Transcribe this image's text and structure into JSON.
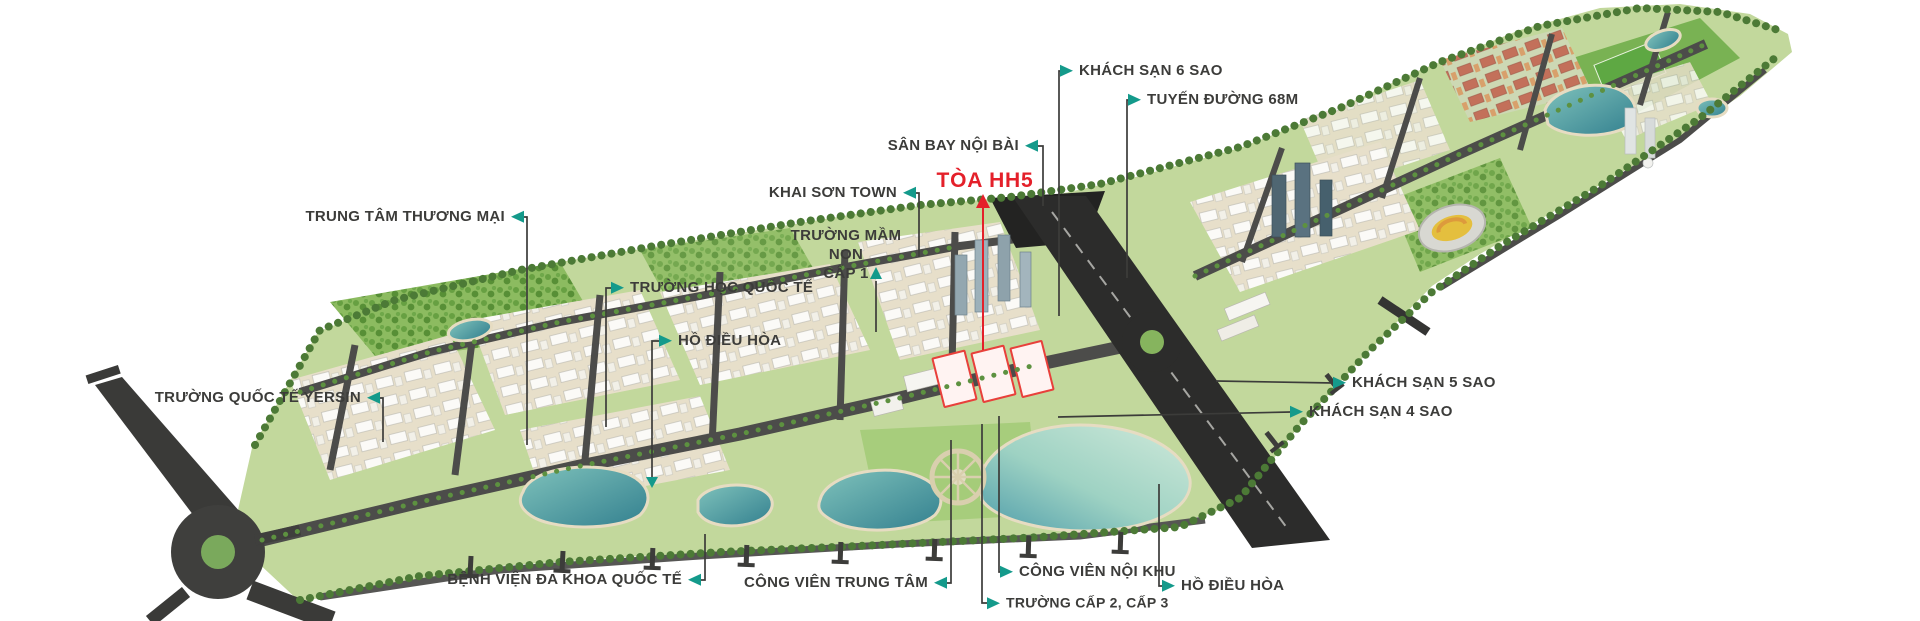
{
  "colors": {
    "accent_teal": "#149a8b",
    "accent_red": "#e4202a",
    "label_text": "#3c3c3a",
    "leader_line": "#3c3c3a",
    "background": "#ffffff"
  },
  "labels": {
    "trung_tam_thuong_mai": "TRUNG TÂM THƯƠNG MẠI",
    "truong_hoc_quoc_te": "TRƯỜNG HỌC QUỐC TẾ",
    "ho_dieu_hoa_tay": "HỒ ĐIỀU HÒA",
    "truong_quoc_te_yersin": "TRƯỜNG QUỐC TẾ YERSIN",
    "khai_son_town": "KHAI SƠN TOWN",
    "truong_mam_non_line1": "TRƯỜNG MẦM NON",
    "truong_mam_non_line2": "CẤP 1",
    "san_bay_noi_bai": "SÂN BAY NỘI BÀI",
    "toa_hh5": "TÒA HH5",
    "khach_san_6_sao": "KHÁCH SẠN 6 SAO",
    "tuyen_duong_68m": "TUYẾN ĐƯỜNG 68M",
    "khach_san_5_sao": "KHÁCH SẠN 5 SAO",
    "khach_san_4_sao": "KHÁCH SẠN 4 SAO",
    "benh_vien": "BỆNH VIỆN ĐA KHOA QUỐC TẾ",
    "cong_vien_trung_tam": "CÔNG VIÊN TRUNG TÂM",
    "cong_vien_noi_khu": "CÔNG VIÊN NỘI KHU",
    "truong_cap_2_3": "TRƯỜNG CẤP 2, CẤP 3",
    "ho_dieu_hoa_dong": "HỒ ĐIỀU HÒA"
  }
}
